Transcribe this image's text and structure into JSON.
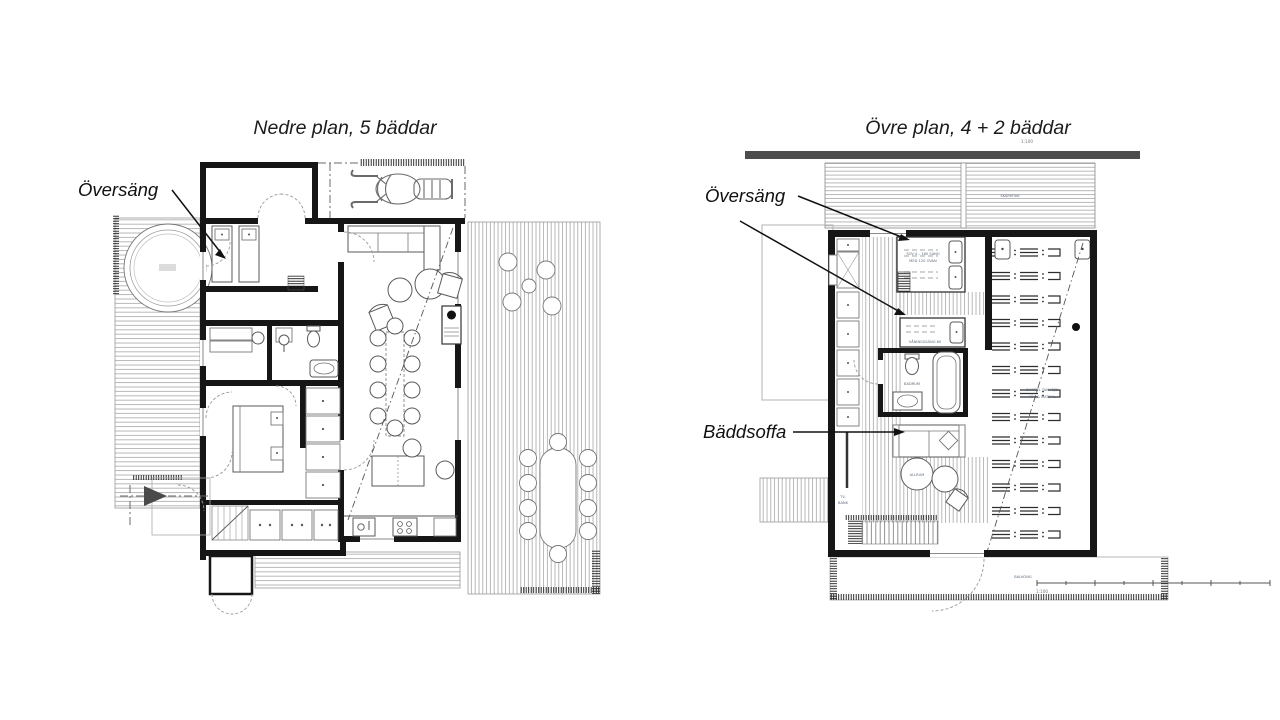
{
  "left_plan": {
    "title": "Nedre plan, 5 bäddar",
    "label_oversang": "Översäng"
  },
  "right_plan": {
    "title": "Övre plan, 4 + 2 bäddar",
    "scale_top": "1:100",
    "label_oversang": "Översäng",
    "label_baddsoffa": "Bäddsoffa",
    "texts": {
      "skarmtak": "SKÄRMTAK",
      "bed_note_1": "SOV 4 – 160 SÄNG",
      "bed_note_2": "MED 120 OVAN",
      "bed2_note": "VÅNINGSSÄNG 80",
      "badrum": "BADRUM",
      "allrum": "ALLRUM",
      "tv_1": "TV-",
      "tv_2": "BÄNK",
      "open_1": "DUBBEL TAKHÖJD",
      "open_2": "KÖK & MATSAL",
      "balkong": "BALKONG",
      "scale_bottom": "1:100"
    }
  },
  "colors": {
    "wall": "#161616",
    "accent_bar": "#4d4d4d",
    "annotation_text": "#5e6b7d"
  }
}
